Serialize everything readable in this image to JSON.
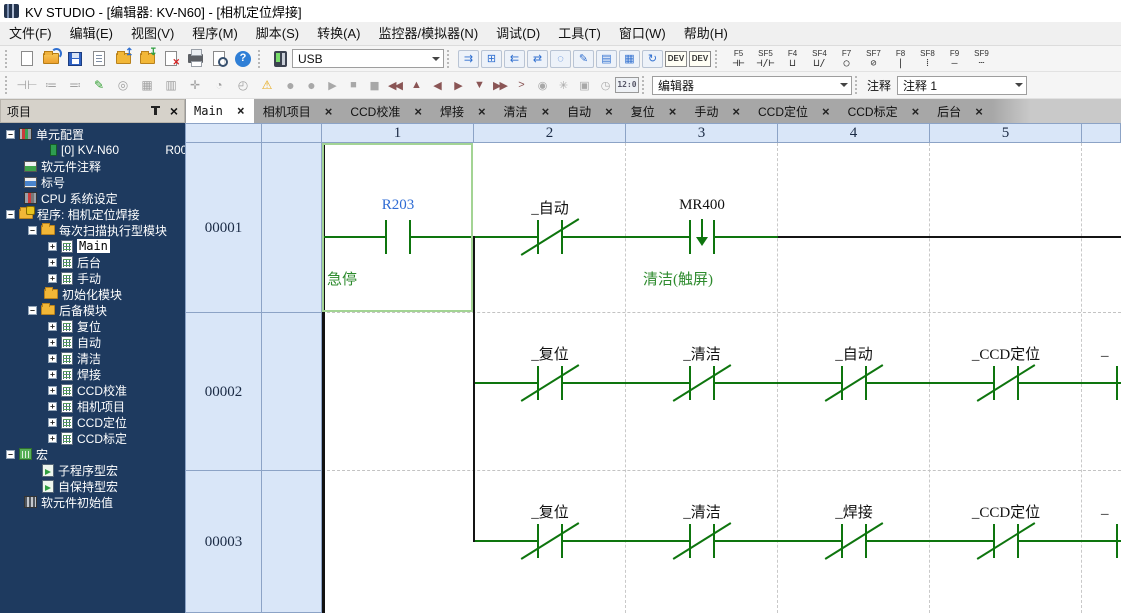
{
  "window": {
    "title": "KV STUDIO - [编辑器: KV-N60] - [相机定位焊接]"
  },
  "menu": {
    "items": [
      "文件(F)",
      "编辑(E)",
      "视图(V)",
      "程序(M)",
      "脚本(S)",
      "转换(A)",
      "监控器/模拟器(N)",
      "调试(D)",
      "工具(T)",
      "窗口(W)",
      "帮助(H)"
    ]
  },
  "toolbar_top": {
    "connection_value": "USB",
    "transfer": [
      "⇉",
      "⊞",
      "⇇",
      "⇄",
      "◌",
      "✎",
      "▤",
      "▦",
      "↻"
    ],
    "dev_badges": [
      "DEV",
      "DEV"
    ],
    "fkeys": [
      {
        "key": "F5",
        "glyph": "⊣⊢"
      },
      {
        "key": "SF5",
        "glyph": "⊣/⊢"
      },
      {
        "key": "F4",
        "glyph": "⊔"
      },
      {
        "key": "SF4",
        "glyph": "⊔/"
      },
      {
        "key": "F7",
        "glyph": "○"
      },
      {
        "key": "SF7",
        "glyph": "⊘"
      },
      {
        "key": "F8",
        "glyph": "|"
      },
      {
        "key": "SF8",
        "glyph": "⁞"
      },
      {
        "key": "F9",
        "glyph": "—"
      },
      {
        "key": "SF9",
        "glyph": "┄"
      }
    ]
  },
  "toolbar_edit": {
    "left_icons": [
      "⊣⊢",
      "≔",
      "≕",
      "✎",
      "◎",
      "▦",
      "▥",
      "✛",
      "◔",
      "◴",
      "⚠"
    ],
    "playback": [
      "●",
      "●",
      "▶",
      "■",
      "▮▮",
      "◀◀",
      "▲",
      "◀",
      "▶",
      "▼",
      "▶▶",
      ">",
      "◉",
      "✳",
      "▣",
      "◷"
    ],
    "clock_badge": "12:0",
    "mode_value": "编辑器",
    "comment_label": "注释",
    "comment_value": "注释 1"
  },
  "tabs": {
    "close": "×",
    "items": [
      "Main",
      "相机项目",
      "CCD校准",
      "焊接",
      "清洁",
      "自动",
      "复位",
      "手动",
      "CCD定位",
      "CCD标定",
      "后台"
    ]
  },
  "project": {
    "header": "项目",
    "unit_right": "R000",
    "tree": [
      "单元配置",
      "[0]  KV-N60",
      "软元件注释",
      "标号",
      "CPU 系统设定",
      "程序: 相机定位焊接",
      "每次扫描执行型模块",
      "Main",
      "后台",
      "手动",
      "初始化模块",
      "后备模块",
      "复位",
      "自动",
      "清洁",
      "焊接",
      "CCD校准",
      "相机项目",
      "CCD定位",
      "CCD标定",
      "宏",
      "子程序型宏",
      "自保持型宏",
      "软元件初始值"
    ]
  },
  "ladder": {
    "column_headers": [
      "1",
      "2",
      "3",
      "4",
      "5"
    ],
    "rungs": [
      {
        "number": "00001",
        "contacts": [
          {
            "label": "R203",
            "type": "no",
            "comment": "急停"
          },
          {
            "label": "_自动",
            "type": "nc",
            "comment": ""
          },
          {
            "label": "MR400",
            "type": "falling",
            "comment": "清洁(触屏)"
          }
        ]
      },
      {
        "number": "00002",
        "contacts": [
          {
            "label": "_复位",
            "type": "nc"
          },
          {
            "label": "_清洁",
            "type": "nc"
          },
          {
            "label": "_自动",
            "type": "nc"
          },
          {
            "label": "_CCD定位",
            "type": "nc"
          },
          {
            "label": "_",
            "type": "nc-partial"
          }
        ]
      },
      {
        "number": "00003",
        "contacts": [
          {
            "label": "_复位",
            "type": "nc"
          },
          {
            "label": "_清洁",
            "type": "nc"
          },
          {
            "label": "_焊接",
            "type": "nc"
          },
          {
            "label": "_CCD定位",
            "type": "nc"
          },
          {
            "label": "_",
            "type": "nc-partial"
          }
        ]
      }
    ],
    "colors": {
      "wire_green": "#0e750e",
      "wire_black": "#141414",
      "device_blue": "#2e6bd4",
      "comment_green": "#2e8b2e",
      "selection_green": "#a3d494"
    }
  }
}
